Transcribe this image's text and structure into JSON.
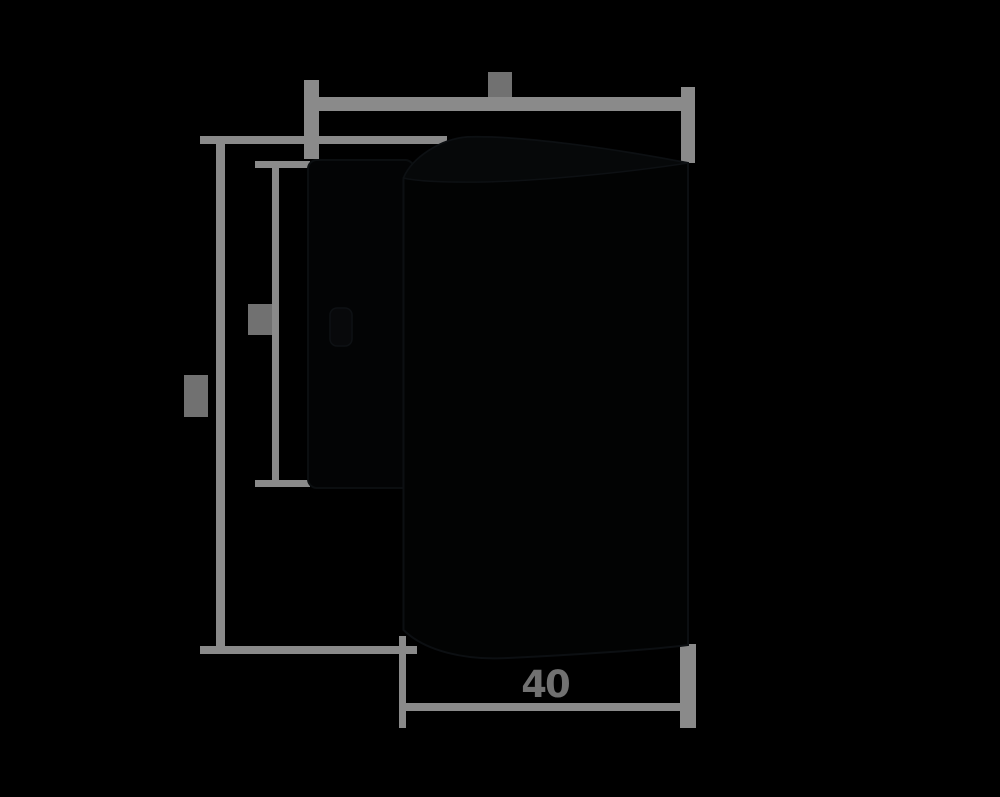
{
  "canvas": {
    "width": 1000,
    "height": 797,
    "background_color": "#000000"
  },
  "palette": {
    "dimension_line_color": "#8a8a8a",
    "dimension_label_color": "#717171",
    "product_fill_color": "#030405",
    "product_edge_color": "#0b0e10"
  },
  "diagram": {
    "kind": "product dimension drawing, cylindrical fixture with back plate, side view, black background",
    "dimensions": [
      {
        "id": "overall-width",
        "position": "top",
        "orientation": "horizontal",
        "label_text": "",
        "label_legible": false
      },
      {
        "id": "overall-height",
        "position": "left-outer",
        "orientation": "vertical",
        "label_text": "",
        "label_legible": false
      },
      {
        "id": "back-plate-height",
        "position": "left-inner",
        "orientation": "vertical",
        "label_text": "",
        "label_legible": false
      },
      {
        "id": "body-diameter",
        "position": "bottom",
        "orientation": "horizontal",
        "label_text": "40",
        "label_legible": true
      }
    ]
  }
}
